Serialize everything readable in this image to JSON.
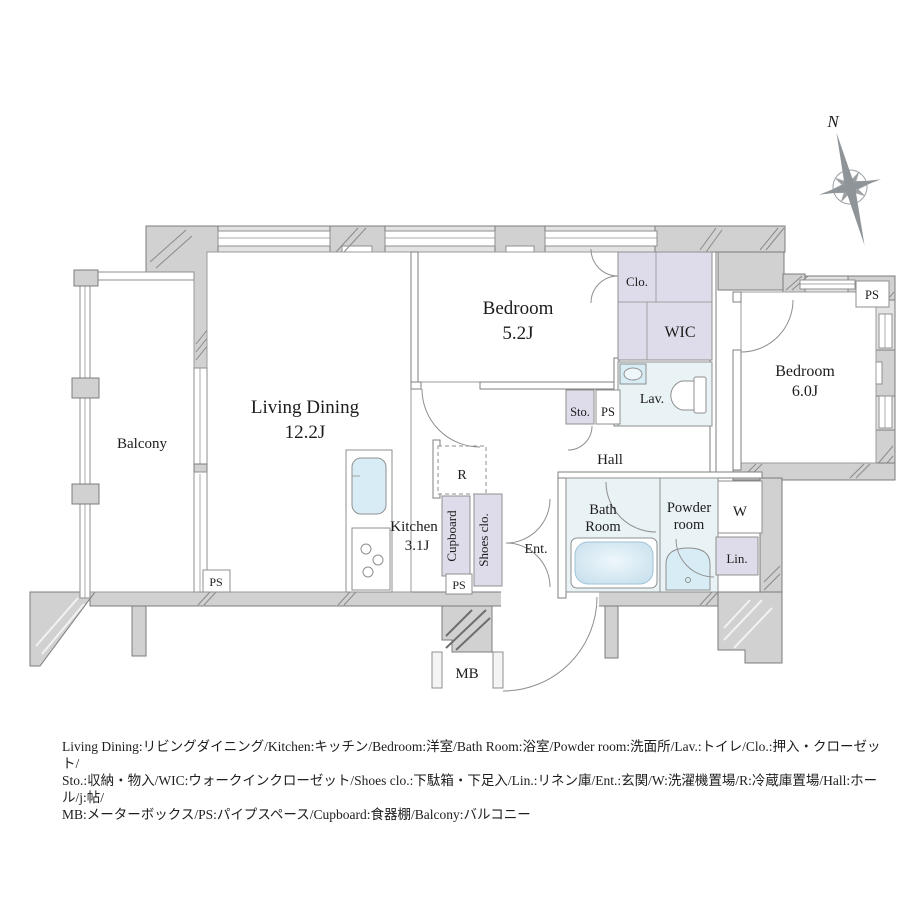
{
  "compass": {
    "north_label": "N"
  },
  "rooms": {
    "balcony": {
      "label": "Balcony"
    },
    "living_dining": {
      "label": "Living Dining",
      "area": "12.2J"
    },
    "kitchen": {
      "label": "Kitchen",
      "area": "3.1J"
    },
    "bedroom_small": {
      "label": "Bedroom",
      "area": "5.2J"
    },
    "bedroom_large": {
      "label": "Bedroom",
      "area": "6.0J"
    },
    "closet": {
      "label": "Clo."
    },
    "wic": {
      "label": "WIC"
    },
    "lavatory": {
      "label": "Lav."
    },
    "storage": {
      "label": "Sto."
    },
    "ps": {
      "label": "PS"
    },
    "hall": {
      "label": "Hall"
    },
    "bath": {
      "line1": "Bath",
      "line2": "Room"
    },
    "powder": {
      "line1": "Powder",
      "line2": "room"
    },
    "washer": {
      "label": "W"
    },
    "linen": {
      "label": "Lin."
    },
    "entrance": {
      "label": "Ent."
    },
    "shoes_closet": {
      "label": "Shoes clo."
    },
    "cupboard": {
      "label": "Cupboard"
    },
    "refrigerator": {
      "label": "R"
    },
    "meter_box": {
      "label": "MB"
    }
  },
  "legend": {
    "line1": "Living Dining:リビングダイニング/Kitchen:キッチン/Bedroom:洋室/Bath Room:浴室/Powder room:洗面所/Lav.:トイレ/Clo.:押入・クローゼット/",
    "line2": "Sto.:収納・物入/WIC:ウォークインクローゼット/Shoes clo.:下駄箱・下足入/Lin.:リネン庫/Ent.:玄関/W:洗濯機置場/R:冷蔵庫置場/Hall:ホール/j:帖/",
    "line3": "MB:メーターボックス/PS:パイプスペース/Cupboard:食器棚/Balcony:バルコニー"
  },
  "colors": {
    "wall_gray": "#d1d1d1",
    "wall_band": "#e3e3e3",
    "wall_stroke": "#7c7c7c",
    "storage_lavender": "#dedcea",
    "wet_area_blue": "#e9f3f6",
    "fixture_blue": "#d8ecf5",
    "tub_blue": "#cfe4ef",
    "text": "#1c1c1c",
    "compass_gray": "#93989c"
  }
}
